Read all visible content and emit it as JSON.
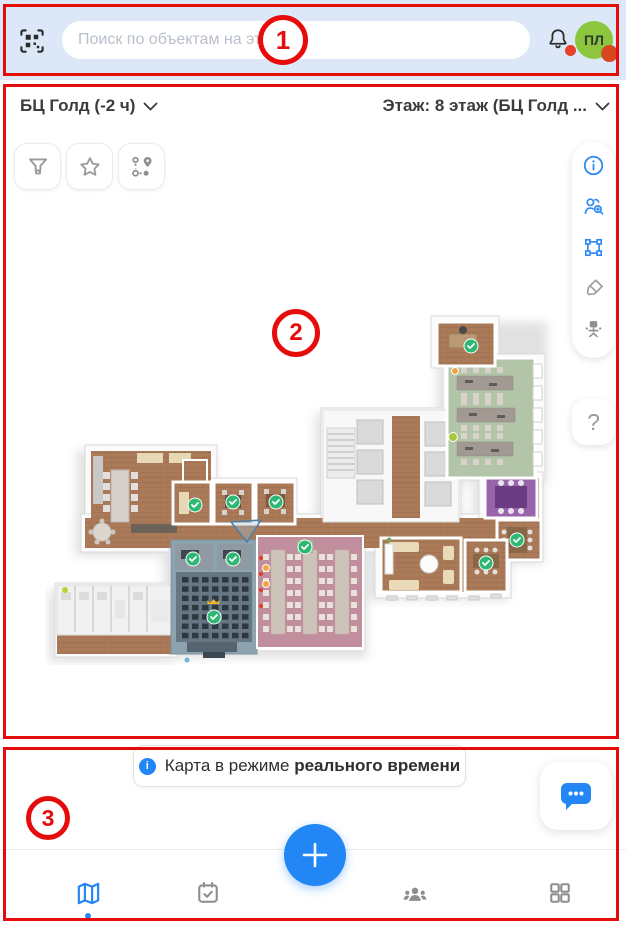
{
  "top_bar": {
    "search_placeholder": "Поиск по объектам на этаже",
    "avatar_initials": "ПЛ"
  },
  "map_header": {
    "building": "БЦ Голд  (-2 ч)",
    "floor": "Этаж: 8 этаж (БЦ Голд ..."
  },
  "help_label": "?",
  "banner": {
    "text": "Карта в режиме ",
    "bold": "реального времени"
  },
  "annotations": {
    "one": "1",
    "two": "2",
    "three": "3"
  },
  "icons": [
    "qr-scan-icon",
    "search-input",
    "bell-icon",
    "avatar",
    "filter-icon",
    "star-icon",
    "route-icon",
    "info-icon",
    "find-person-icon",
    "select-area-icon",
    "highlighter-icon",
    "workplace-icon",
    "help-icon",
    "chat-icon",
    "plus-icon",
    "map-icon",
    "tasks-icon",
    "people-icon",
    "apps-grid-icon",
    "info-dot-icon"
  ],
  "colors": {
    "accent_blue": "#2287f5",
    "topbar_bg": "#dce8f8",
    "avatar_green": "#8cc63e",
    "status_orange": "#d6491e",
    "notification_red": "#e8402a",
    "annotation_red": "#e60c0c",
    "icon_gray": "#9a9a9a"
  }
}
